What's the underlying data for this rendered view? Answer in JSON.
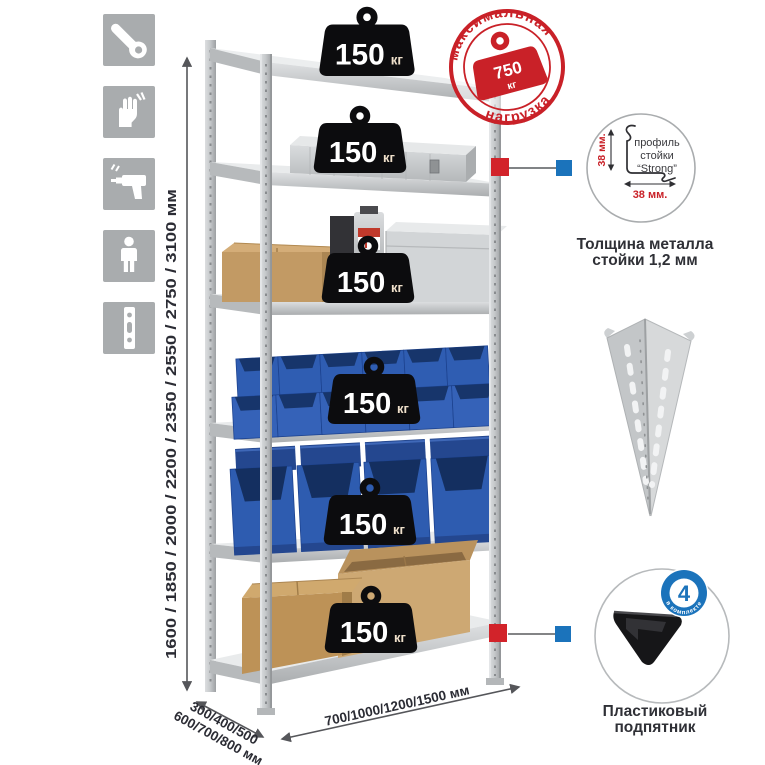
{
  "sidebar_icons": [
    {
      "name": "wrench-icon"
    },
    {
      "name": "gloves-icon"
    },
    {
      "name": "drill-icon"
    },
    {
      "name": "person-icon"
    },
    {
      "name": "perforated-profile-icon"
    }
  ],
  "dimensions": {
    "height_label": "1600 / 1850 / 2000 / 2200 / 2350 / 2550 / 2750 / 3100 мм",
    "depth_label_line1": "300/400/500",
    "depth_label_line2": "600/700/800 мм",
    "width_label": "700/1000/1200/1500 мм"
  },
  "shelf_badge": {
    "value": "150",
    "unit": "кг",
    "count_on_rack": 6
  },
  "stamp": {
    "arc_top": "максимальная",
    "arc_bottom": "нагрузка",
    "value": "750",
    "unit": "кг"
  },
  "profile_detail": {
    "label_line1": "профиль",
    "label_line2": "стойки",
    "label_line3": "“Strong”",
    "vertical_dim": "38 мм.",
    "horizontal_dim": "38 мм.",
    "caption_line1": "Толщина металла",
    "caption_line2": "стойки 1,2 мм"
  },
  "foot_detail": {
    "badge_count": "4",
    "badge_label": "в комплекте",
    "caption_line1": "Пластиковый",
    "caption_line2": "подпятник"
  },
  "colors": {
    "accent_red": "#c92128",
    "marker_blue": "#1b73bb",
    "bin_blue": "#2e5cb0",
    "metal_gray": "#c9ccce",
    "cardboard": "#c59c66",
    "badge_black": "#0c0c0e"
  }
}
